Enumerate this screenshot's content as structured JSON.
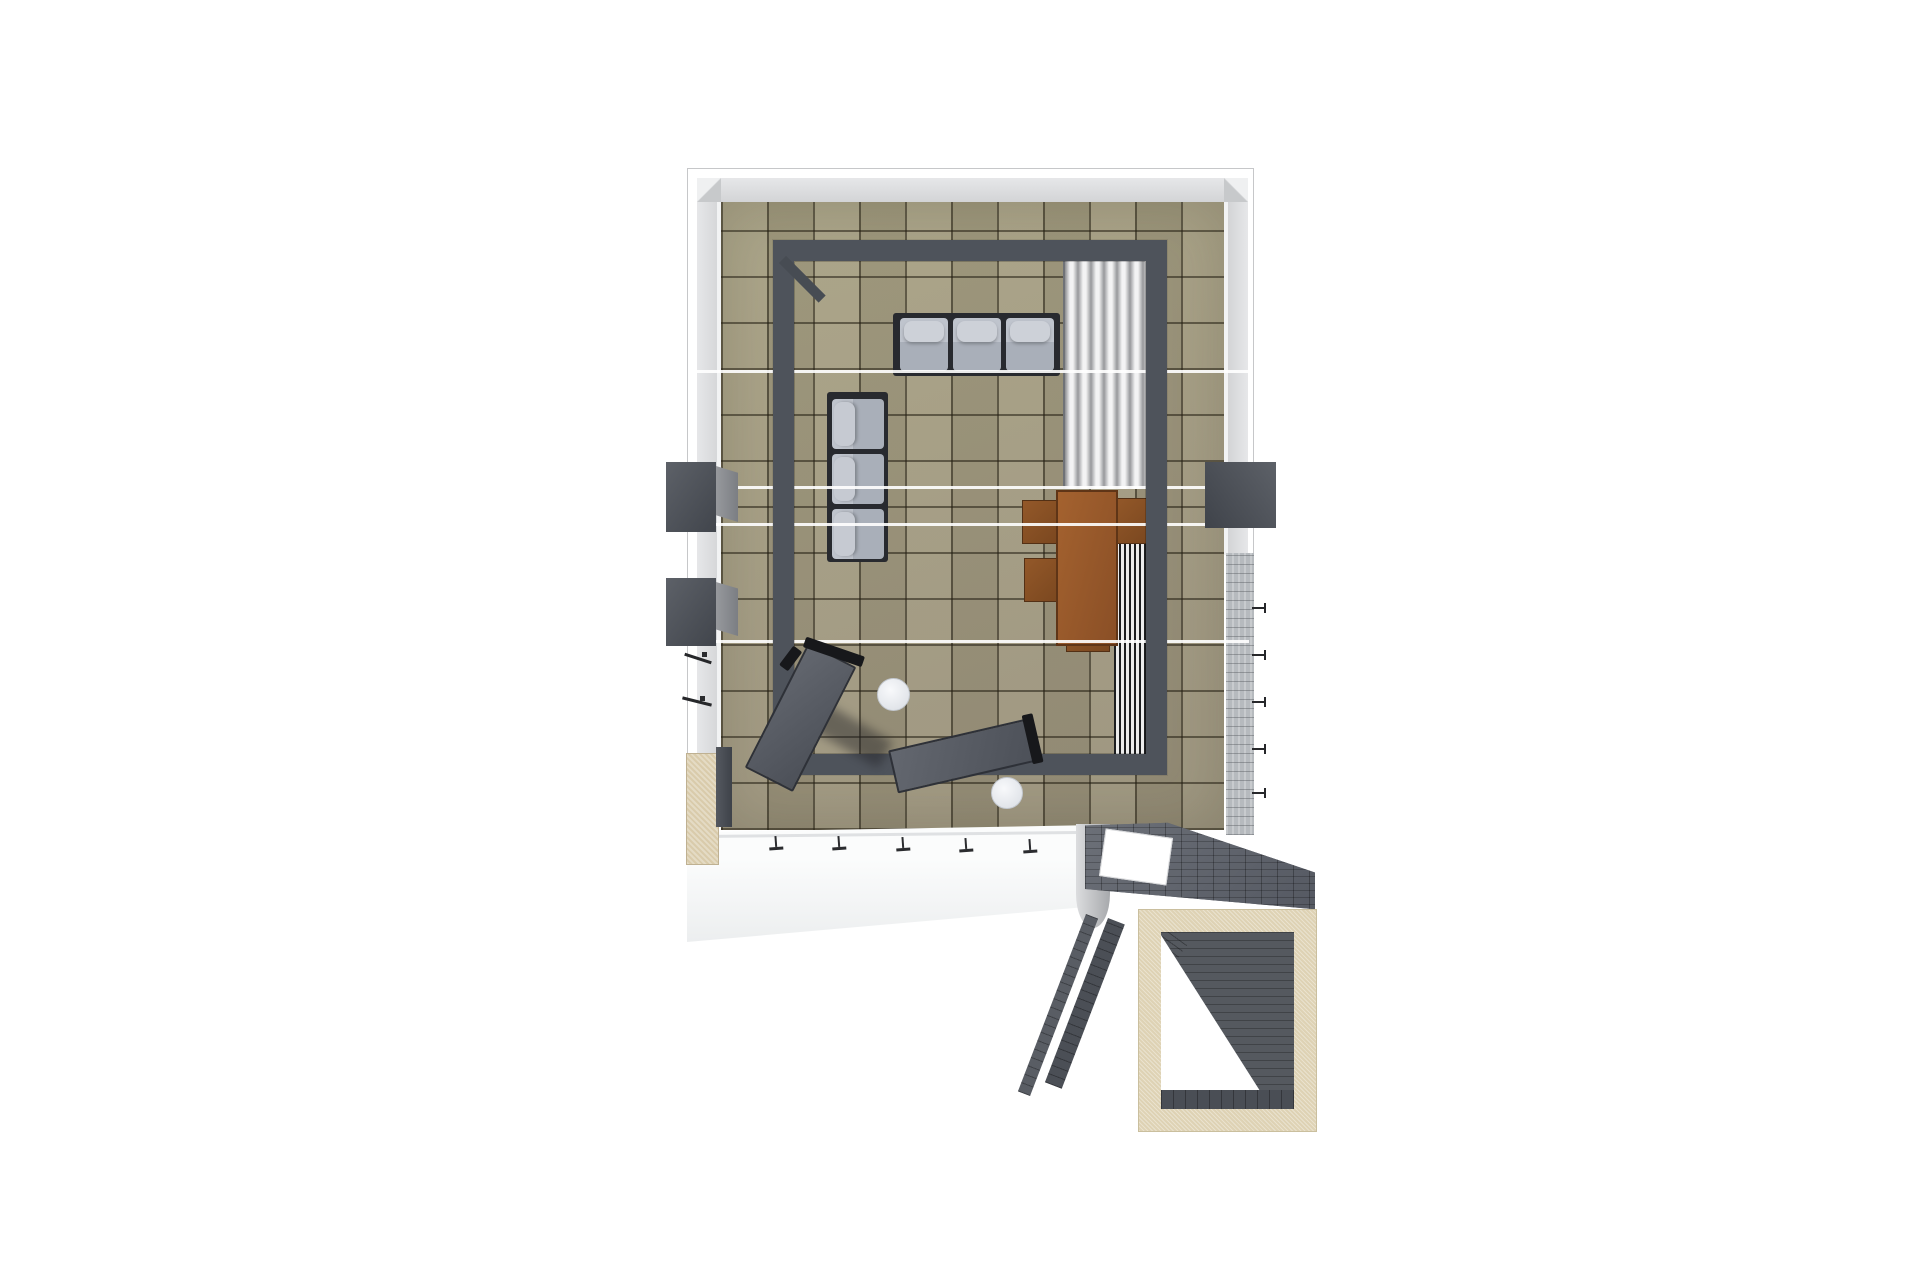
{
  "scene": {
    "type": "3d-floorplan-top-down-render",
    "room_elements": [
      "outer-wall",
      "tiled-floor",
      "steel-frame",
      "corner-brace",
      "curtain-panel",
      "floor-grille",
      "glass-door-handles",
      "beige-column",
      "terrace",
      "stone-walkway",
      "skylight-opening",
      "stone-rails",
      "entry-portal",
      "portal-ramp"
    ],
    "furniture": [
      {
        "name": "three-seat-sofa-top",
        "seats": 3,
        "color_key": "sofa_cushion"
      },
      {
        "name": "three-seat-sofa-left",
        "seats": 3,
        "color_key": "sofa_cushion"
      },
      {
        "name": "dining-table",
        "color_key": "table_wood"
      },
      {
        "name": "dining-chair",
        "count": 4,
        "color_key": "chair_wood"
      },
      {
        "name": "chaise-lounge",
        "count": 2,
        "color_key": "chaise"
      },
      {
        "name": "round-side-table",
        "count": 2,
        "color_key": "side_table"
      },
      {
        "name": "wall-box-left",
        "count": 2,
        "color_key": "box_dark"
      },
      {
        "name": "wall-box-right",
        "count": 1,
        "color_key": "box_dark"
      }
    ],
    "section_lines": 4,
    "terrace_handle_marks": 5,
    "wall_tick_marks": 5
  },
  "palette": {
    "background": "#ffffff",
    "wall_face": "#d3d4d6",
    "wall_outline": "#c6c7c9",
    "tile": "#a39b7f",
    "tile_grout": "#3f3a2e",
    "frame": "#4e535b",
    "sofa_cushion": "#a9afb9",
    "sofa_pillow": "#bfc4cd",
    "sofa_frame": "#282a2f",
    "curtain_light": "#f3f3f4",
    "curtain_dark": "#97989b",
    "table_wood": "#9a5b2d",
    "chair_wood": "#87512a",
    "chaise": "#5a5e66",
    "chaise_bar": "#17181b",
    "side_table": "#eef0f4",
    "box_dark": "#52565d",
    "beige": "#d9cbab",
    "terrace": "#eceeef",
    "stone_dark": "#61656d",
    "stone_light": "#b6babe",
    "portal_beige": "#ded2b4",
    "white_line": "#ffffff"
  }
}
